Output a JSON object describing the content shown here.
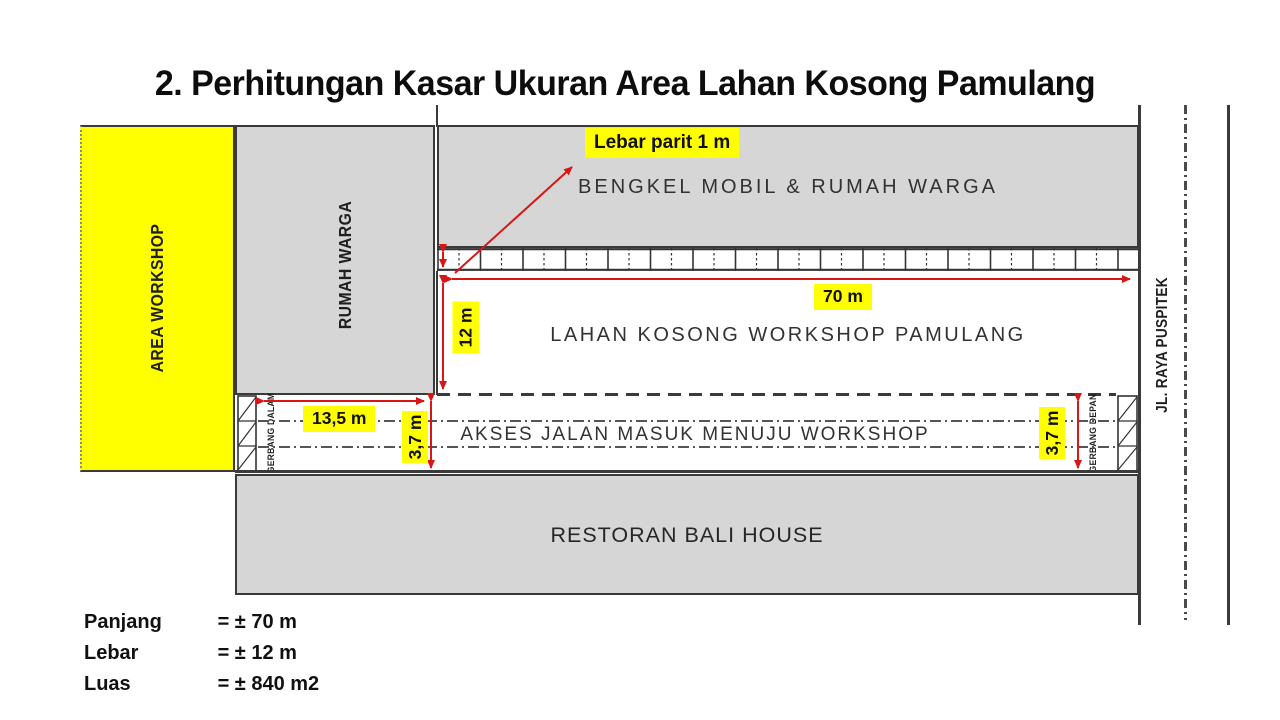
{
  "title": "2. Perhitungan Kasar Ukuran Area Lahan Kosong Pamulang",
  "zones": {
    "area_workshop": {
      "label": "AREA WORKSHOP"
    },
    "rumah_warga": {
      "label": "RUMAH WARGA"
    },
    "bengkel": {
      "label": "BENGKEL MOBIL & RUMAH WARGA"
    },
    "lahan_kosong": {
      "label": "LAHAN KOSONG WORKSHOP PAMULANG"
    },
    "akses_jalan": {
      "label": "AKSES JALAN MASUK MENUJU WORKSHOP"
    },
    "restoran": {
      "label": "RESTORAN BALI HOUSE"
    },
    "jalan_raya": {
      "label": "JL. RAYA PUSPITEK"
    },
    "gerbang_dalam": {
      "label": "GERBANG DALAM"
    },
    "gerbang_depan": {
      "label": "GERBANG DEPAN"
    }
  },
  "dims": {
    "lebar_parit": "Lebar parit 1 m",
    "panjang_70": "70 m",
    "lebar_12": "12 m",
    "akses_13_5": "13,5 m",
    "lebar_3_7_kiri": "3,7 m",
    "lebar_3_7_kanan": "3,7 m"
  },
  "summary": {
    "rows": [
      {
        "label": "Panjang",
        "value": "= ± 70 m"
      },
      {
        "label": "Lebar",
        "value": "= ± 12 m"
      },
      {
        "label": "Luas",
        "value": "= ± 840 m2"
      }
    ]
  },
  "colors": {
    "highlight_yellow": "#ffff00",
    "zone_gray": "#d6d6d6",
    "line_dark": "#3a3a3a",
    "dimension_red": "#d81616"
  }
}
